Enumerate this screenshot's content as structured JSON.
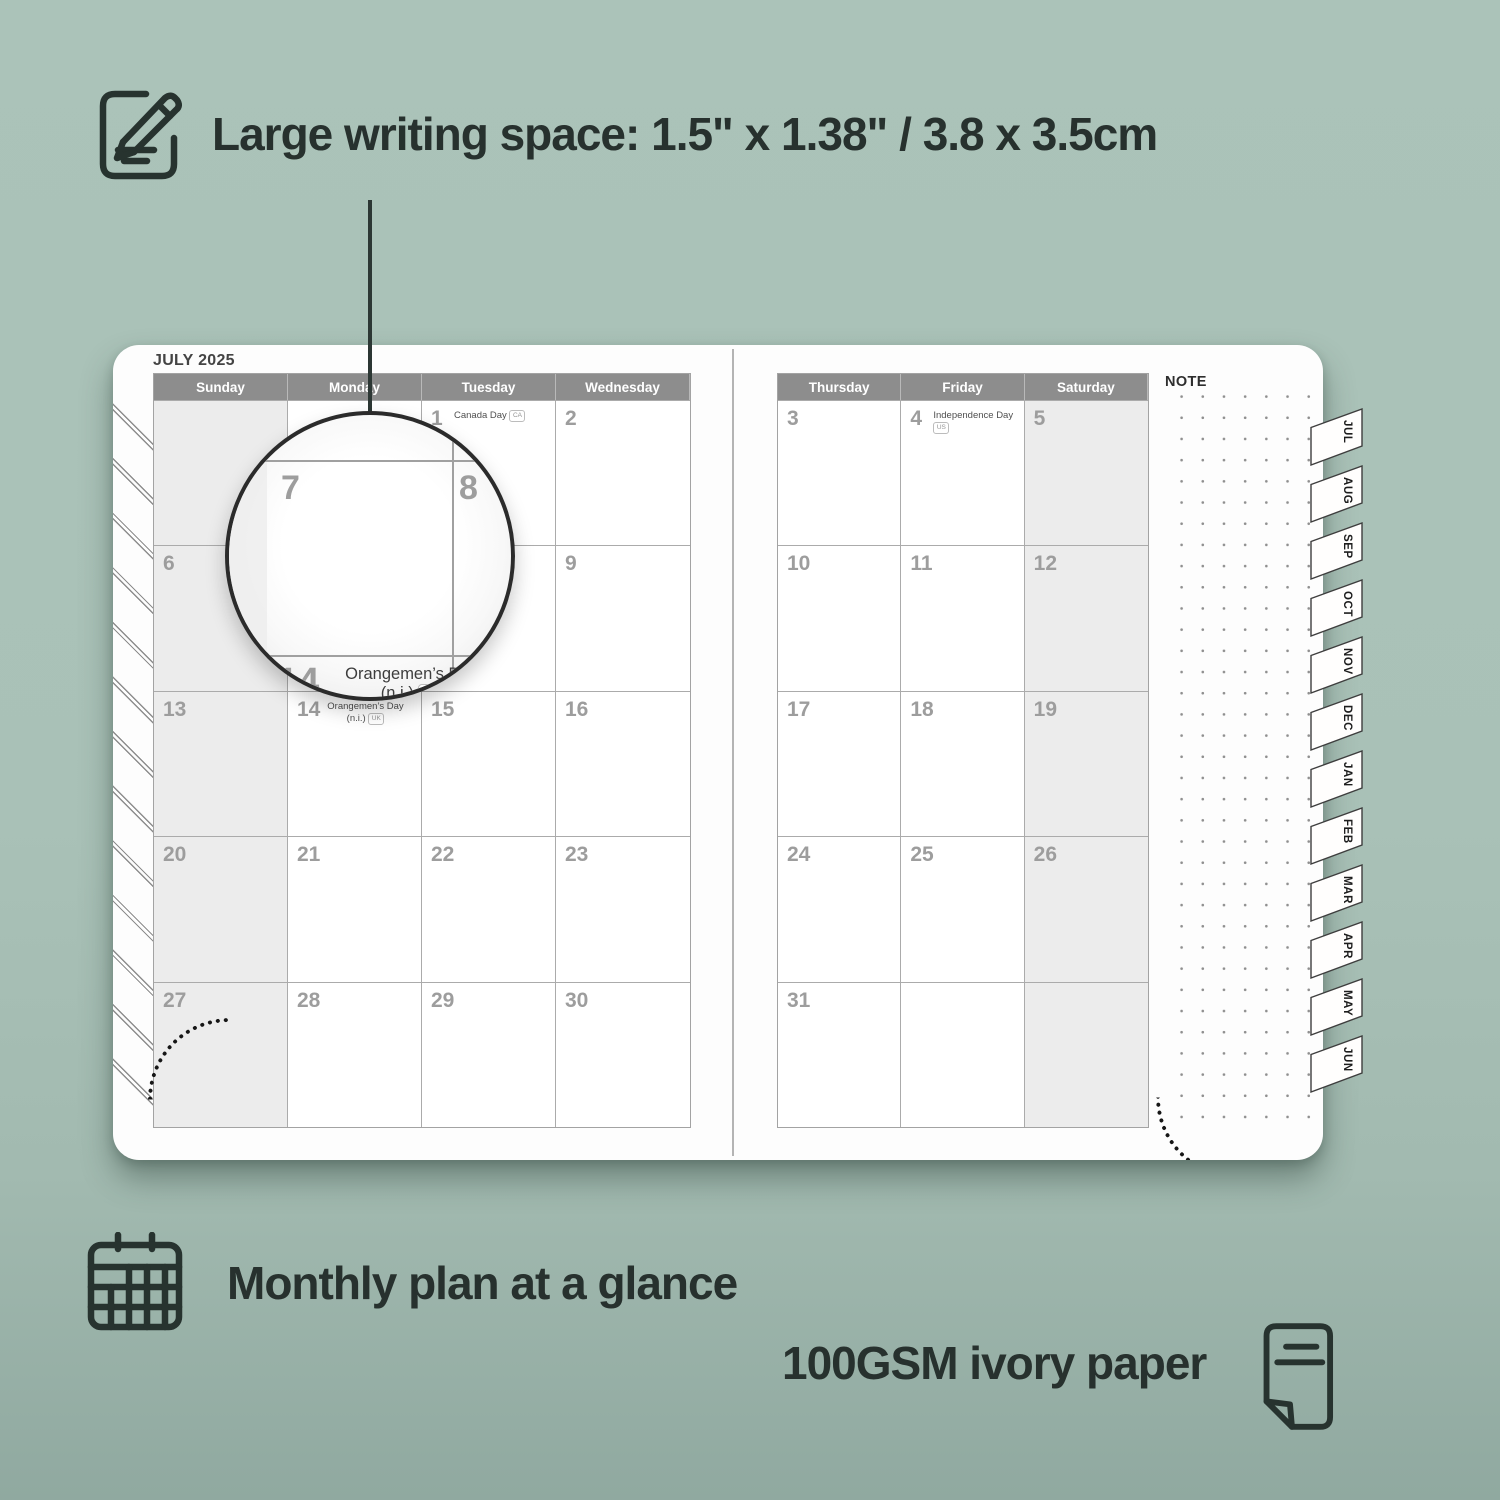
{
  "colors": {
    "background_top": "#abc3b9",
    "background_bottom": "#90a9a0",
    "ink": "#27312e",
    "page": "#fdfdfd",
    "header_bar": "#8d8d8d",
    "header_text": "#ffffff",
    "day_number": "#9d9d9d",
    "grid_line": "#ababab",
    "shaded_cell": "#ececec"
  },
  "features": {
    "writing_space": {
      "icon": "notepad-pencil-icon",
      "text": "Large writing space: 1.5\" x 1.38\" / 3.8 x 3.5cm"
    },
    "monthly_plan": {
      "icon": "calendar-grid-icon",
      "text": "Monthly plan at a glance"
    },
    "paper": {
      "icon": "paper-sheet-icon",
      "text": "100GSM ivory paper"
    }
  },
  "planner": {
    "month_title": "JULY 2025",
    "note_label": "NOTE",
    "left_page": {
      "day_headers": [
        "Sunday",
        "Monday",
        "Tuesday",
        "Wednesday"
      ],
      "rows": [
        [
          {
            "day": "",
            "shaded": true
          },
          {
            "day": ""
          },
          {
            "day": "1",
            "holiday": "Canada Day",
            "badge": "CA"
          },
          {
            "day": "2"
          }
        ],
        [
          {
            "day": "6",
            "shaded": true
          },
          {
            "day": "7"
          },
          {
            "day": "8"
          },
          {
            "day": "9"
          }
        ],
        [
          {
            "day": "13",
            "shaded": true
          },
          {
            "day": "14",
            "holiday": "Orangemen’s Day",
            "holiday_line2": "(n.i.)",
            "badge": "UK"
          },
          {
            "day": "15"
          },
          {
            "day": "16"
          }
        ],
        [
          {
            "day": "20",
            "shaded": true
          },
          {
            "day": "21"
          },
          {
            "day": "22"
          },
          {
            "day": "23"
          }
        ],
        [
          {
            "day": "27",
            "shaded": true
          },
          {
            "day": "28"
          },
          {
            "day": "29"
          },
          {
            "day": "30"
          }
        ]
      ]
    },
    "right_page": {
      "day_headers": [
        "Thursday",
        "Friday",
        "Saturday"
      ],
      "rows": [
        [
          {
            "day": "3"
          },
          {
            "day": "4",
            "holiday": "Independence Day",
            "badge": "US"
          },
          {
            "day": "5",
            "shaded": true
          }
        ],
        [
          {
            "day": "10"
          },
          {
            "day": "11"
          },
          {
            "day": "12",
            "shaded": true
          }
        ],
        [
          {
            "day": "17"
          },
          {
            "day": "18"
          },
          {
            "day": "19",
            "shaded": true
          }
        ],
        [
          {
            "day": "24"
          },
          {
            "day": "25"
          },
          {
            "day": "26",
            "shaded": true
          }
        ],
        [
          {
            "day": "31"
          },
          {
            "day": ""
          },
          {
            "day": "",
            "shaded": true
          }
        ]
      ]
    },
    "month_tabs": [
      "JUL",
      "AUG",
      "SEP",
      "OCT",
      "NOV",
      "DEC",
      "JAN",
      "FEB",
      "MAR",
      "APR",
      "MAY",
      "JUN"
    ],
    "magnifier": {
      "day_top_left": "7",
      "day_top_right": "8",
      "day_bottom": "14",
      "holiday_line1": "Orangemen’s Day",
      "holiday_line2": "(n.i.)",
      "badge": "UK"
    }
  }
}
